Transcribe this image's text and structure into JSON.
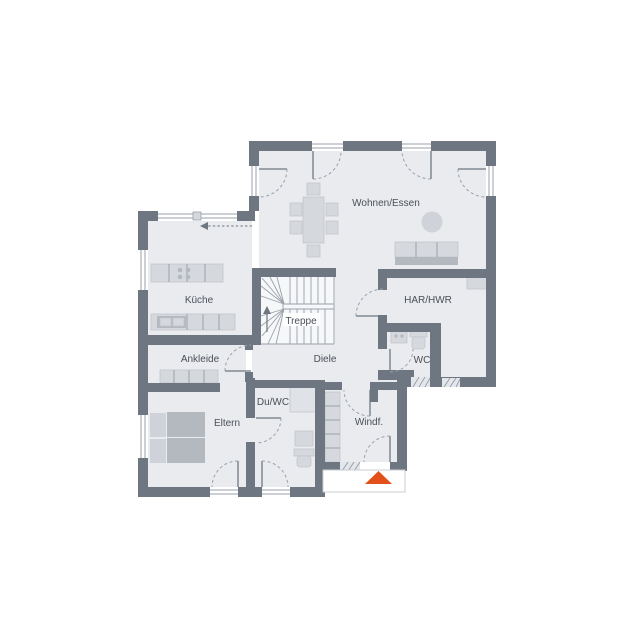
{
  "rooms": {
    "wohnen_essen": "Wohnen/Essen",
    "kueche": "Küche",
    "treppe": "Treppe",
    "har_hwr": "HAR/HWR",
    "wc": "WC",
    "diele": "Diele",
    "ankleide": "Ankleide",
    "du_wc": "Du/WC",
    "eltern": "Eltern",
    "windfang": "Windf."
  },
  "colors": {
    "bg": "#ffffff",
    "wall": "#6e7781",
    "floor": "#e9ebef",
    "stairfloor": "#f6f7f9",
    "furn": "#d5d8dd",
    "furnmid": "#cfd2d8",
    "furndark": "#b4b8bf",
    "line": "#9aa1aa",
    "text": "#4a5058",
    "accent": "#e2511c"
  }
}
